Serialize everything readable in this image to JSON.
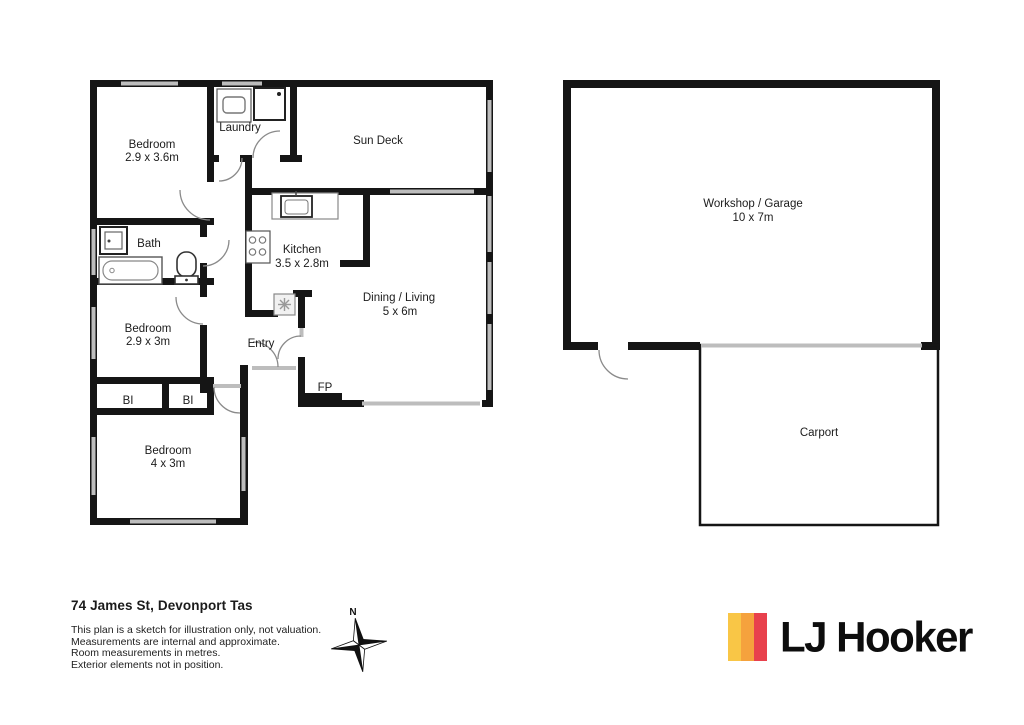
{
  "plan": {
    "address": "74 James St, Devonport Tas",
    "disclaimer": [
      "This plan is a sketch for illustration only, not valuation.",
      "Measurements are internal and approximate.",
      "Room measurements in metres.",
      "Exterior elements not in position."
    ],
    "compass": {
      "north_label": "N"
    },
    "rooms": {
      "bedroom1": {
        "label": "Bedroom",
        "dims": "2.9 x 3.6m"
      },
      "laundry": {
        "label": "Laundry"
      },
      "sun_deck": {
        "label": "Sun Deck"
      },
      "bath": {
        "label": "Bath"
      },
      "kitchen": {
        "label": "Kitchen",
        "dims": "3.5 x 2.8m"
      },
      "dining_living": {
        "label": "Dining / Living",
        "dims": "5 x 6m"
      },
      "bedroom2": {
        "label": "Bedroom",
        "dims": "2.9 x 3m"
      },
      "entry": {
        "label": "Entry"
      },
      "fireplace": {
        "label": "FP"
      },
      "bi_left": {
        "label": "BI"
      },
      "bi_right": {
        "label": "BI"
      },
      "bedroom3": {
        "label": "Bedroom",
        "dims": "4 x 3m"
      },
      "workshop": {
        "label": "Workshop / Garage",
        "dims": "10 x 7m"
      },
      "carport": {
        "label": "Carport"
      }
    },
    "logo": {
      "text": "LJ Hooker",
      "colors": {
        "yellow": "#F9C646",
        "orange": "#F5A23D",
        "red": "#E8414D"
      }
    }
  }
}
